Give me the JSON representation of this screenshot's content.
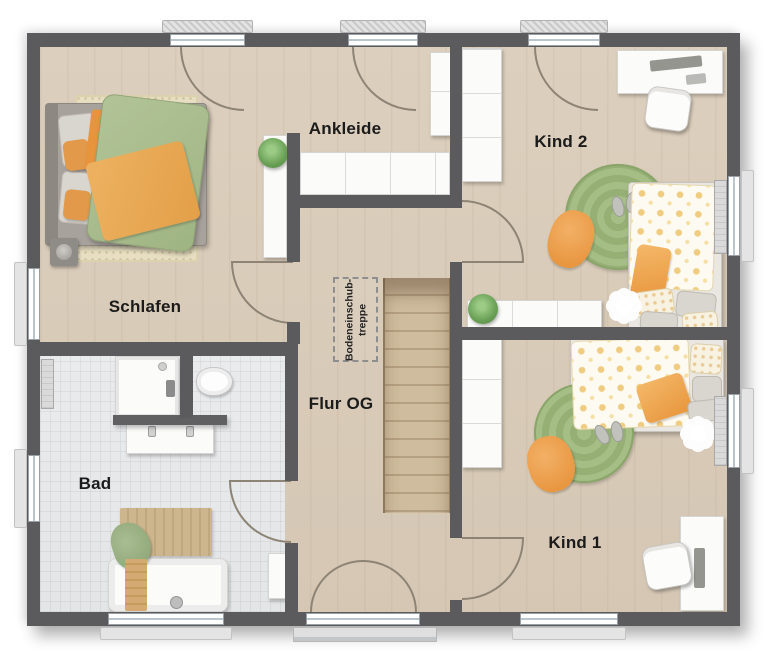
{
  "plan": {
    "rooms": [
      {
        "id": "schlafen",
        "label": "Schlafen"
      },
      {
        "id": "ankleide",
        "label": "Ankleide"
      },
      {
        "id": "kind2",
        "label": "Kind 2"
      },
      {
        "id": "kind1",
        "label": "Kind 1"
      },
      {
        "id": "bad",
        "label": "Bad"
      },
      {
        "id": "flur_og",
        "label": "Flur OG"
      }
    ],
    "attic_stairs": {
      "line1": "Bodeneinschub-",
      "line2": "treppe"
    },
    "colors": {
      "wall": "#5b5b5d",
      "floor_wood": "#d8cbb9",
      "floor_tile": "#e7e8ea",
      "stair_wood": "#c3ae8f",
      "accent_orange": "#efa14b",
      "duvet_green": "#a9bd8d",
      "rug_green": "#9cb97d",
      "furniture_white": "#fbfbfa",
      "door_arc": "#8d8475"
    }
  }
}
